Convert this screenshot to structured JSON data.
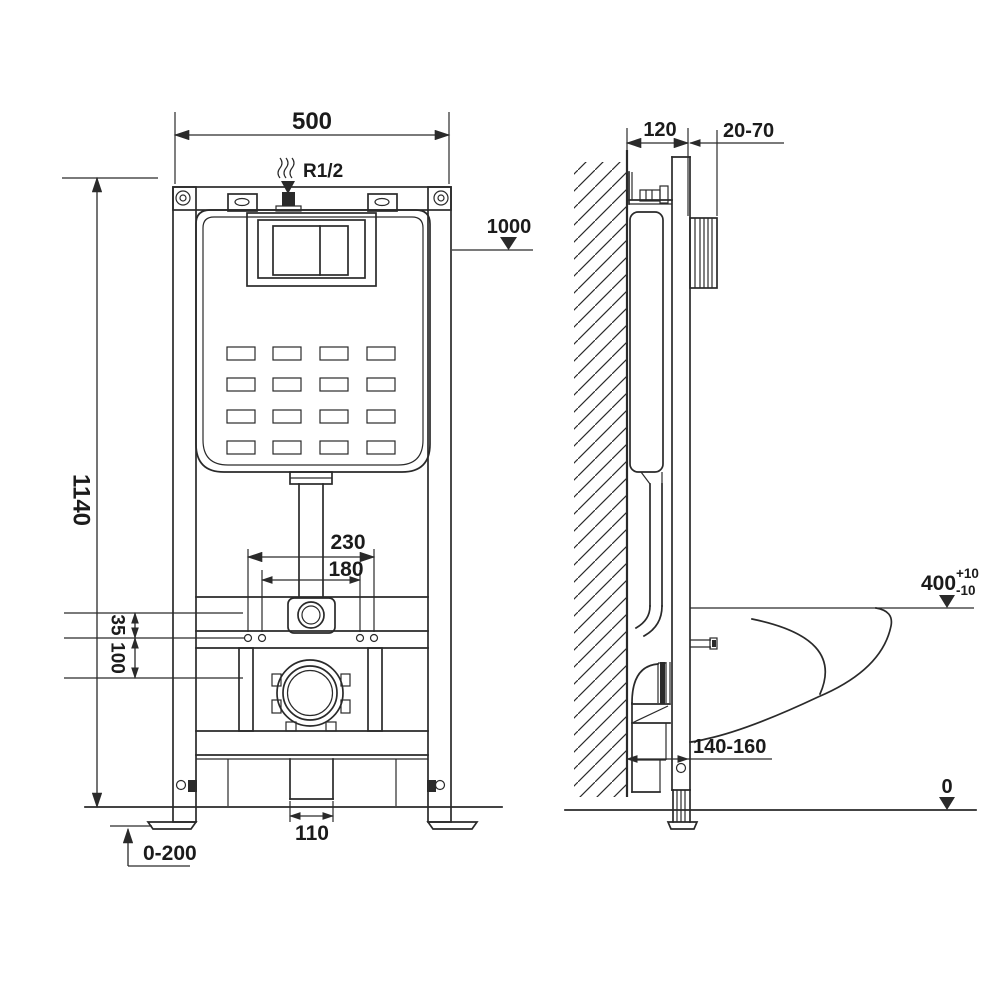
{
  "drawing_title": "wall-hung-toilet-installation-frame-dimensions",
  "dimensions": {
    "front": {
      "frame_width": "500",
      "water_supply": "R1/2",
      "flush_level": "1000",
      "frame_height": "1140",
      "outer_fixing_span": "230",
      "inner_fixing_span": "180",
      "offset_small": "35",
      "offset_large": "100",
      "waste_pipe_width": "110",
      "leg_adjustment": "0-200"
    },
    "side": {
      "frame_depth": "120",
      "wall_finish_range": "20-70",
      "bowl_height": "400",
      "bowl_height_tol_plus": "+10",
      "bowl_height_tol_minus": "-10",
      "waste_outlet_range": "140-160",
      "floor_level": "0"
    }
  },
  "colors": {
    "line": "#2a2a2a",
    "text": "#1b1b1b",
    "background": "#ffffff"
  }
}
